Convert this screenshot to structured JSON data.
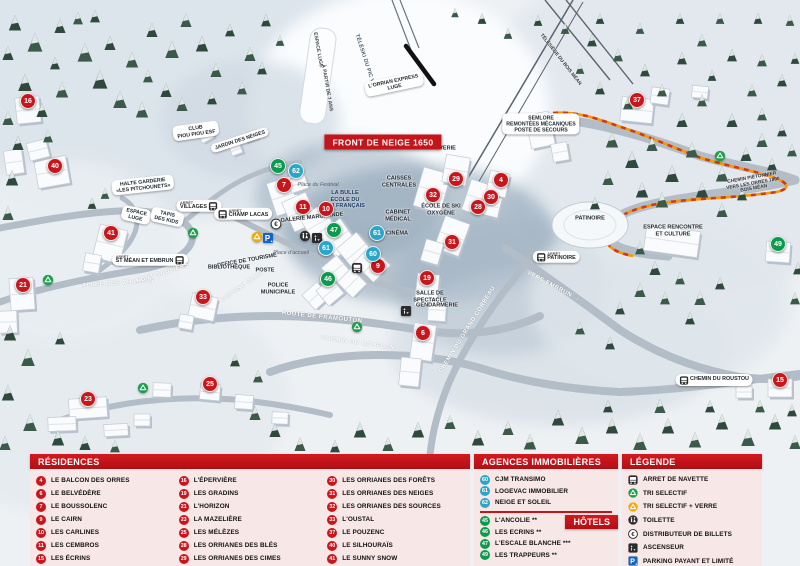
{
  "map": {
    "banner": "FRONT DE NEIGE 1650",
    "marker_colors": {
      "residence": "#c8161d",
      "hotel": "#0c9b4e",
      "agency": "#2ba6c9"
    },
    "markers": [
      {
        "n": "16",
        "c": "residence",
        "x": 28,
        "y": 101
      },
      {
        "n": "40",
        "c": "residence",
        "x": 55,
        "y": 166
      },
      {
        "n": "41",
        "c": "residence",
        "x": 111,
        "y": 233
      },
      {
        "n": "21",
        "c": "residence",
        "x": 23,
        "y": 285
      },
      {
        "n": "33",
        "c": "residence",
        "x": 203,
        "y": 297
      },
      {
        "n": "23",
        "c": "residence",
        "x": 88,
        "y": 399
      },
      {
        "n": "25",
        "c": "residence",
        "x": 210,
        "y": 384
      },
      {
        "n": "7",
        "c": "residence",
        "x": 284,
        "y": 185
      },
      {
        "n": "11",
        "c": "residence",
        "x": 303,
        "y": 207
      },
      {
        "n": "10",
        "c": "residence",
        "x": 326,
        "y": 209
      },
      {
        "n": "9",
        "c": "residence",
        "x": 378,
        "y": 266
      },
      {
        "n": "19",
        "c": "residence",
        "x": 427,
        "y": 278
      },
      {
        "n": "6",
        "c": "residence",
        "x": 423,
        "y": 333
      },
      {
        "n": "29",
        "c": "residence",
        "x": 456,
        "y": 179
      },
      {
        "n": "4",
        "c": "residence",
        "x": 501,
        "y": 180
      },
      {
        "n": "32",
        "c": "residence",
        "x": 433,
        "y": 195
      },
      {
        "n": "30",
        "c": "residence",
        "x": 491,
        "y": 197
      },
      {
        "n": "28",
        "c": "residence",
        "x": 478,
        "y": 207
      },
      {
        "n": "31",
        "c": "residence",
        "x": 452,
        "y": 242
      },
      {
        "n": "37",
        "c": "residence",
        "x": 637,
        "y": 100
      },
      {
        "n": "15",
        "c": "residence",
        "x": 780,
        "y": 380
      },
      {
        "n": "45",
        "c": "hotel",
        "x": 278,
        "y": 166
      },
      {
        "n": "47",
        "c": "hotel",
        "x": 334,
        "y": 230
      },
      {
        "n": "46",
        "c": "hotel",
        "x": 328,
        "y": 279
      },
      {
        "n": "49",
        "c": "hotel",
        "x": 778,
        "y": 244
      },
      {
        "n": "62",
        "c": "agency",
        "x": 296,
        "y": 171
      },
      {
        "n": "61",
        "c": "agency",
        "x": 326,
        "y": 248
      },
      {
        "n": "61",
        "c": "agency",
        "x": 377,
        "y": 233
      },
      {
        "n": "60",
        "c": "agency",
        "x": 373,
        "y": 254
      }
    ],
    "labels": [
      {
        "t": [
          "ESPACE LUGE"
        ],
        "x": 317,
        "y": 50,
        "r": 80,
        "c": "strip"
      },
      {
        "t": [
          "À PARTIR DE 7 ANS"
        ],
        "x": 326,
        "y": 88,
        "r": 80,
        "c": "strip"
      },
      {
        "t": [
          "TÉLÉSKI DU PIC VERT"
        ],
        "x": 366,
        "y": 64,
        "r": 72,
        "c": "road"
      },
      {
        "t": [
          "TÉLÉSIÈGE DU BOIS MÉAN"
        ],
        "x": 560,
        "y": 60,
        "r": 52,
        "c": "road-sm"
      },
      {
        "t": [
          "L'ORRIAN EXPRESS",
          "LUGE"
        ],
        "x": 394,
        "y": 84,
        "r": -12,
        "c": "pill"
      },
      {
        "t": [
          "CLUB",
          "PIOU PIOU ESF"
        ],
        "x": 196,
        "y": 131,
        "r": -8,
        "c": "pill"
      },
      {
        "t": [
          "JARDIN DES NEIGES"
        ],
        "x": 240,
        "y": 140,
        "r": -18,
        "c": "pill"
      },
      {
        "t": [
          "HALTE GARDERIE",
          "«LES PITCHOUNETS»"
        ],
        "x": 143,
        "y": 185,
        "r": -6,
        "c": "pill"
      },
      {
        "t": [
          "ESPACE",
          "LUGE"
        ],
        "x": 136,
        "y": 215,
        "r": 12,
        "c": "pill"
      },
      {
        "t": [
          "TAPIS",
          "DES KIDS"
        ],
        "x": 167,
        "y": 217,
        "r": 12,
        "c": "pill"
      },
      {
        "t": [
          "VILLAGES"
        ],
        "x": 199,
        "y": 206,
        "r": 0,
        "c": "stop",
        "sub": "ARRÊT",
        "side": "right"
      },
      {
        "t": [
          "SEMLORE",
          "REMONTÉES MÉCANIQUES",
          "POSTE DE SECOURS"
        ],
        "x": 541,
        "y": 124,
        "r": 0,
        "c": "pill"
      },
      {
        "t": [
          "LAVERIE"
        ],
        "x": 444,
        "y": 149,
        "r": 0,
        "c": "place"
      },
      {
        "t": [
          "CAISSES",
          "CENTRALES"
        ],
        "x": 399,
        "y": 182,
        "r": 0,
        "c": "place"
      },
      {
        "t": [
          "Place du Festival"
        ],
        "x": 318,
        "y": 185,
        "r": 0,
        "c": "italic"
      },
      {
        "t": [
          "LA BULLE",
          "ÉCOLE DU",
          "SKI FRANÇAIS"
        ],
        "x": 345,
        "y": 200,
        "r": 0,
        "c": "place-blue"
      },
      {
        "t": [
          "GALERIE MARCHANDE"
        ],
        "x": 312,
        "y": 218,
        "r": -6,
        "c": "place"
      },
      {
        "t": [
          "ÉCOLE DE SKI",
          "OXYGÈNE"
        ],
        "x": 441,
        "y": 210,
        "r": 0,
        "c": "place"
      },
      {
        "t": [
          "CABINET",
          "MÉDICAL"
        ],
        "x": 398,
        "y": 216,
        "r": 0,
        "c": "place"
      },
      {
        "t": [
          "CINÉMA"
        ],
        "x": 397,
        "y": 234,
        "r": 0,
        "c": "place"
      },
      {
        "t": [
          "CHAMP LACAS"
        ],
        "x": 243,
        "y": 214,
        "r": 0,
        "c": "stop",
        "sub": "ARRÊT",
        "side": "left"
      },
      {
        "t": [
          "OFFICE DE TOURISME"
        ],
        "x": 247,
        "y": 261,
        "r": -10,
        "c": "place"
      },
      {
        "t": [
          "BIBLIOTHÈQUE"
        ],
        "x": 229,
        "y": 268,
        "r": 0,
        "c": "place"
      },
      {
        "t": [
          "POSTE"
        ],
        "x": 265,
        "y": 271,
        "r": 0,
        "c": "place"
      },
      {
        "t": [
          "Place d'accueil"
        ],
        "x": 291,
        "y": 253,
        "r": 0,
        "c": "italic"
      },
      {
        "t": [
          "POLICE",
          "MUNICIPALE"
        ],
        "x": 278,
        "y": 289,
        "r": 0,
        "c": "place"
      },
      {
        "t": [
          "DÉPOSE CARS"
        ],
        "x": 243,
        "y": 287,
        "r": -35,
        "c": "road-white"
      },
      {
        "t": [
          "SALLE DE",
          "SPECTACLE"
        ],
        "x": 430,
        "y": 297,
        "r": 0,
        "c": "place"
      },
      {
        "t": [
          "GENDARMERIE"
        ],
        "x": 437,
        "y": 306,
        "r": 0,
        "c": "place"
      },
      {
        "t": [
          "PATINOIRE"
        ],
        "x": 590,
        "y": 219,
        "r": 0,
        "c": "place"
      },
      {
        "t": [
          "PATINOIRE"
        ],
        "x": 556,
        "y": 257,
        "r": 0,
        "c": "stop",
        "sub": "ARRÊT",
        "side": "left"
      },
      {
        "t": [
          "ST MÉAN ET EMBRUN"
        ],
        "x": 150,
        "y": 260,
        "r": 0,
        "c": "stop",
        "sub": "ARRÊT",
        "side": "right"
      },
      {
        "t": [
          "ESPACE RENCONTRE",
          "ET CULTURE"
        ],
        "x": 673,
        "y": 231,
        "r": 0,
        "c": "place"
      },
      {
        "t": [
          "CHEMIN PIÉTONNIER",
          "VERS LES ORRES 1800",
          "BOIS MÉAN"
        ],
        "x": 753,
        "y": 184,
        "r": -10,
        "c": "road-sm"
      },
      {
        "t": [
          "VERS EMBRUN →"
        ],
        "x": 553,
        "y": 287,
        "r": 28,
        "c": "road-white"
      },
      {
        "t": [
          "ALLÉE DES CHAMOIS"
        ],
        "x": 118,
        "y": 284,
        "r": -4,
        "c": "road-white"
      },
      {
        "t": [
          "PONT SAULIERS"
        ],
        "x": 163,
        "y": 274,
        "r": -18,
        "c": "road-white"
      },
      {
        "t": [
          "ROUTE DE PRAMOUTON"
        ],
        "x": 322,
        "y": 318,
        "r": 6,
        "c": "road-white"
      },
      {
        "t": [
          "CHEMIN DU MOUFLON"
        ],
        "x": 358,
        "y": 344,
        "r": 8,
        "c": "road-white"
      },
      {
        "t": [
          "CHEMIN DU GRAND CORBEAU"
        ],
        "x": 468,
        "y": 330,
        "r": -58,
        "c": "road-white"
      },
      {
        "t": [
          "CHEMIN DU ROUSTOU"
        ],
        "x": 714,
        "y": 380,
        "r": 0,
        "c": "stop",
        "side": "left"
      }
    ],
    "icons": [
      {
        "icon": "euro",
        "x": 276,
        "y": 224
      },
      {
        "icon": "recycle-yellow",
        "x": 257,
        "y": 237
      },
      {
        "icon": "parking",
        "x": 268,
        "y": 238
      },
      {
        "icon": "toilet",
        "x": 305,
        "y": 236
      },
      {
        "icon": "elevator",
        "x": 317,
        "y": 238
      },
      {
        "icon": "bus",
        "x": 357,
        "y": 268
      },
      {
        "icon": "elevator",
        "x": 406,
        "y": 311
      },
      {
        "icon": "recycle-green",
        "x": 193,
        "y": 233
      },
      {
        "icon": "recycle-green",
        "x": 48,
        "y": 280
      },
      {
        "icon": "recycle-green",
        "x": 357,
        "y": 327
      },
      {
        "icon": "recycle-green",
        "x": 720,
        "y": 156
      },
      {
        "icon": "recycle-green",
        "x": 143,
        "y": 388
      }
    ]
  },
  "legend": {
    "residences": {
      "title": "RÉSIDENCES",
      "columns": [
        [
          {
            "n": "4",
            "label": "LE BALCON DES ORRES"
          },
          {
            "n": "6",
            "label": "LE BELVÉDÈRE"
          },
          {
            "n": "7",
            "label": "LE BOUSSOLENC"
          },
          {
            "n": "9",
            "label": "LE CAIRN"
          },
          {
            "n": "10",
            "label": "LES CARLINES"
          },
          {
            "n": "11",
            "label": "LES CEMBROS"
          },
          {
            "n": "15",
            "label": "LES ÉCRINS"
          }
        ],
        [
          {
            "n": "16",
            "label": "L'ÉPERVIÈRE"
          },
          {
            "n": "19",
            "label": "LES GRADINS"
          },
          {
            "n": "21",
            "label": "L'HORIZON"
          },
          {
            "n": "23",
            "label": "LA MAZELIÈRE"
          },
          {
            "n": "25",
            "label": "LES MÉLÈZES"
          },
          {
            "n": "28",
            "label": "LES ORRIANES DES BLÉS"
          },
          {
            "n": "29",
            "label": "LES ORRIANES DES CIMES"
          }
        ],
        [
          {
            "n": "30",
            "label": "LES ORRIANES DES FORÊTS"
          },
          {
            "n": "31",
            "label": "LES ORRIANES DES NEIGES"
          },
          {
            "n": "32",
            "label": "LES ORRIANES DES SOURCES"
          },
          {
            "n": "33",
            "label": "L'OUSTAL"
          },
          {
            "n": "37",
            "label": "LE POUZENC"
          },
          {
            "n": "40",
            "label": "LE SILHOURAÏS"
          },
          {
            "n": "41",
            "label": "LE SUNNY SNOW"
          }
        ]
      ]
    },
    "agences": {
      "title": "AGENCES IMMOBILIÈRES",
      "items": [
        {
          "n": "60",
          "label": "CJM TRANSIMO"
        },
        {
          "n": "61",
          "label": "LOGEVAC IMMOBILIER"
        },
        {
          "n": "62",
          "label": "NEIGE ET SOLEIL"
        }
      ]
    },
    "hotels": {
      "title": "HÔTELS",
      "items": [
        {
          "n": "45",
          "label": "L'ANCOLIE **"
        },
        {
          "n": "46",
          "label": "LES ECRINS **"
        },
        {
          "n": "47",
          "label": "L'ESCALE BLANCHE ***"
        },
        {
          "n": "49",
          "label": "LES TRAPPEURS **"
        }
      ]
    },
    "legende": {
      "title": "LÉGENDE",
      "items": [
        {
          "icon": "bus",
          "label": "ARRET DE NAVETTE"
        },
        {
          "icon": "recycle-green",
          "label": "TRI SELECTIF"
        },
        {
          "icon": "recycle-yellow",
          "label": "TRI SELECTIF + VERRE"
        },
        {
          "icon": "toilet",
          "label": "TOILETTE"
        },
        {
          "icon": "euro",
          "label": "DISTRIBUTEUR DE BILLETS"
        },
        {
          "icon": "elevator",
          "label": "ASCENSEUR"
        },
        {
          "icon": "parking",
          "label": "PARKING PAYANT ET LIMITÉ"
        }
      ]
    }
  }
}
